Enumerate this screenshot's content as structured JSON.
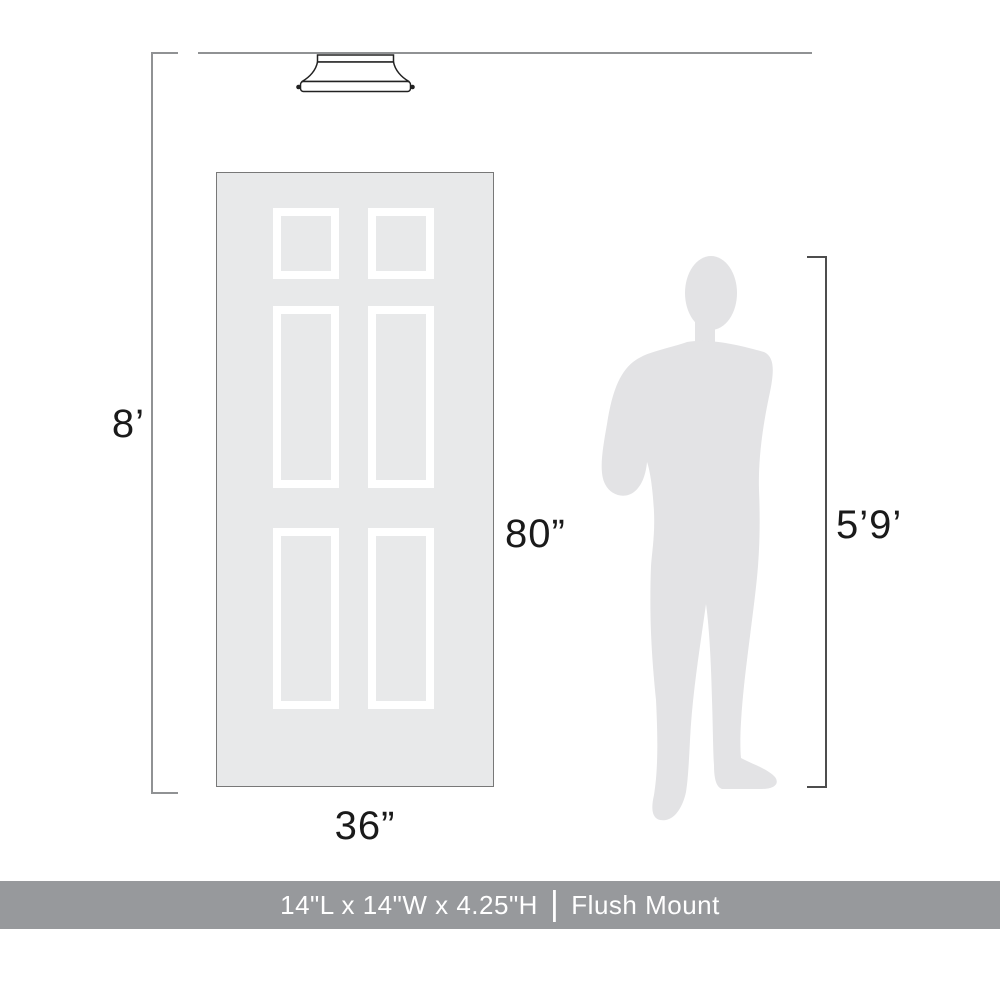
{
  "labels": {
    "ceiling_height": "8’",
    "door_height": "80”",
    "door_width": "36”",
    "person_height": "5’9’"
  },
  "footer": {
    "dimensions": "14\"L x 14\"W x 4.25\"H",
    "separator": "|",
    "mount_type": "Flush Mount"
  },
  "icons": {
    "fixture": "flush-mount-ceiling-light",
    "door": "six-panel-door",
    "person": "man-silhouette"
  },
  "colors": {
    "background": "#ffffff",
    "measure_line": "#909294",
    "person_measure_line": "#4d4d4d",
    "fixture_outline": "#222222",
    "door_fill": "#e8e9ea",
    "door_border": "#787878",
    "panel_frame": "#ffffff",
    "silhouette_fill": "#e3e3e5",
    "label_text": "#1a1a1a",
    "footer_bg": "#97999c",
    "footer_text": "#ffffff"
  }
}
